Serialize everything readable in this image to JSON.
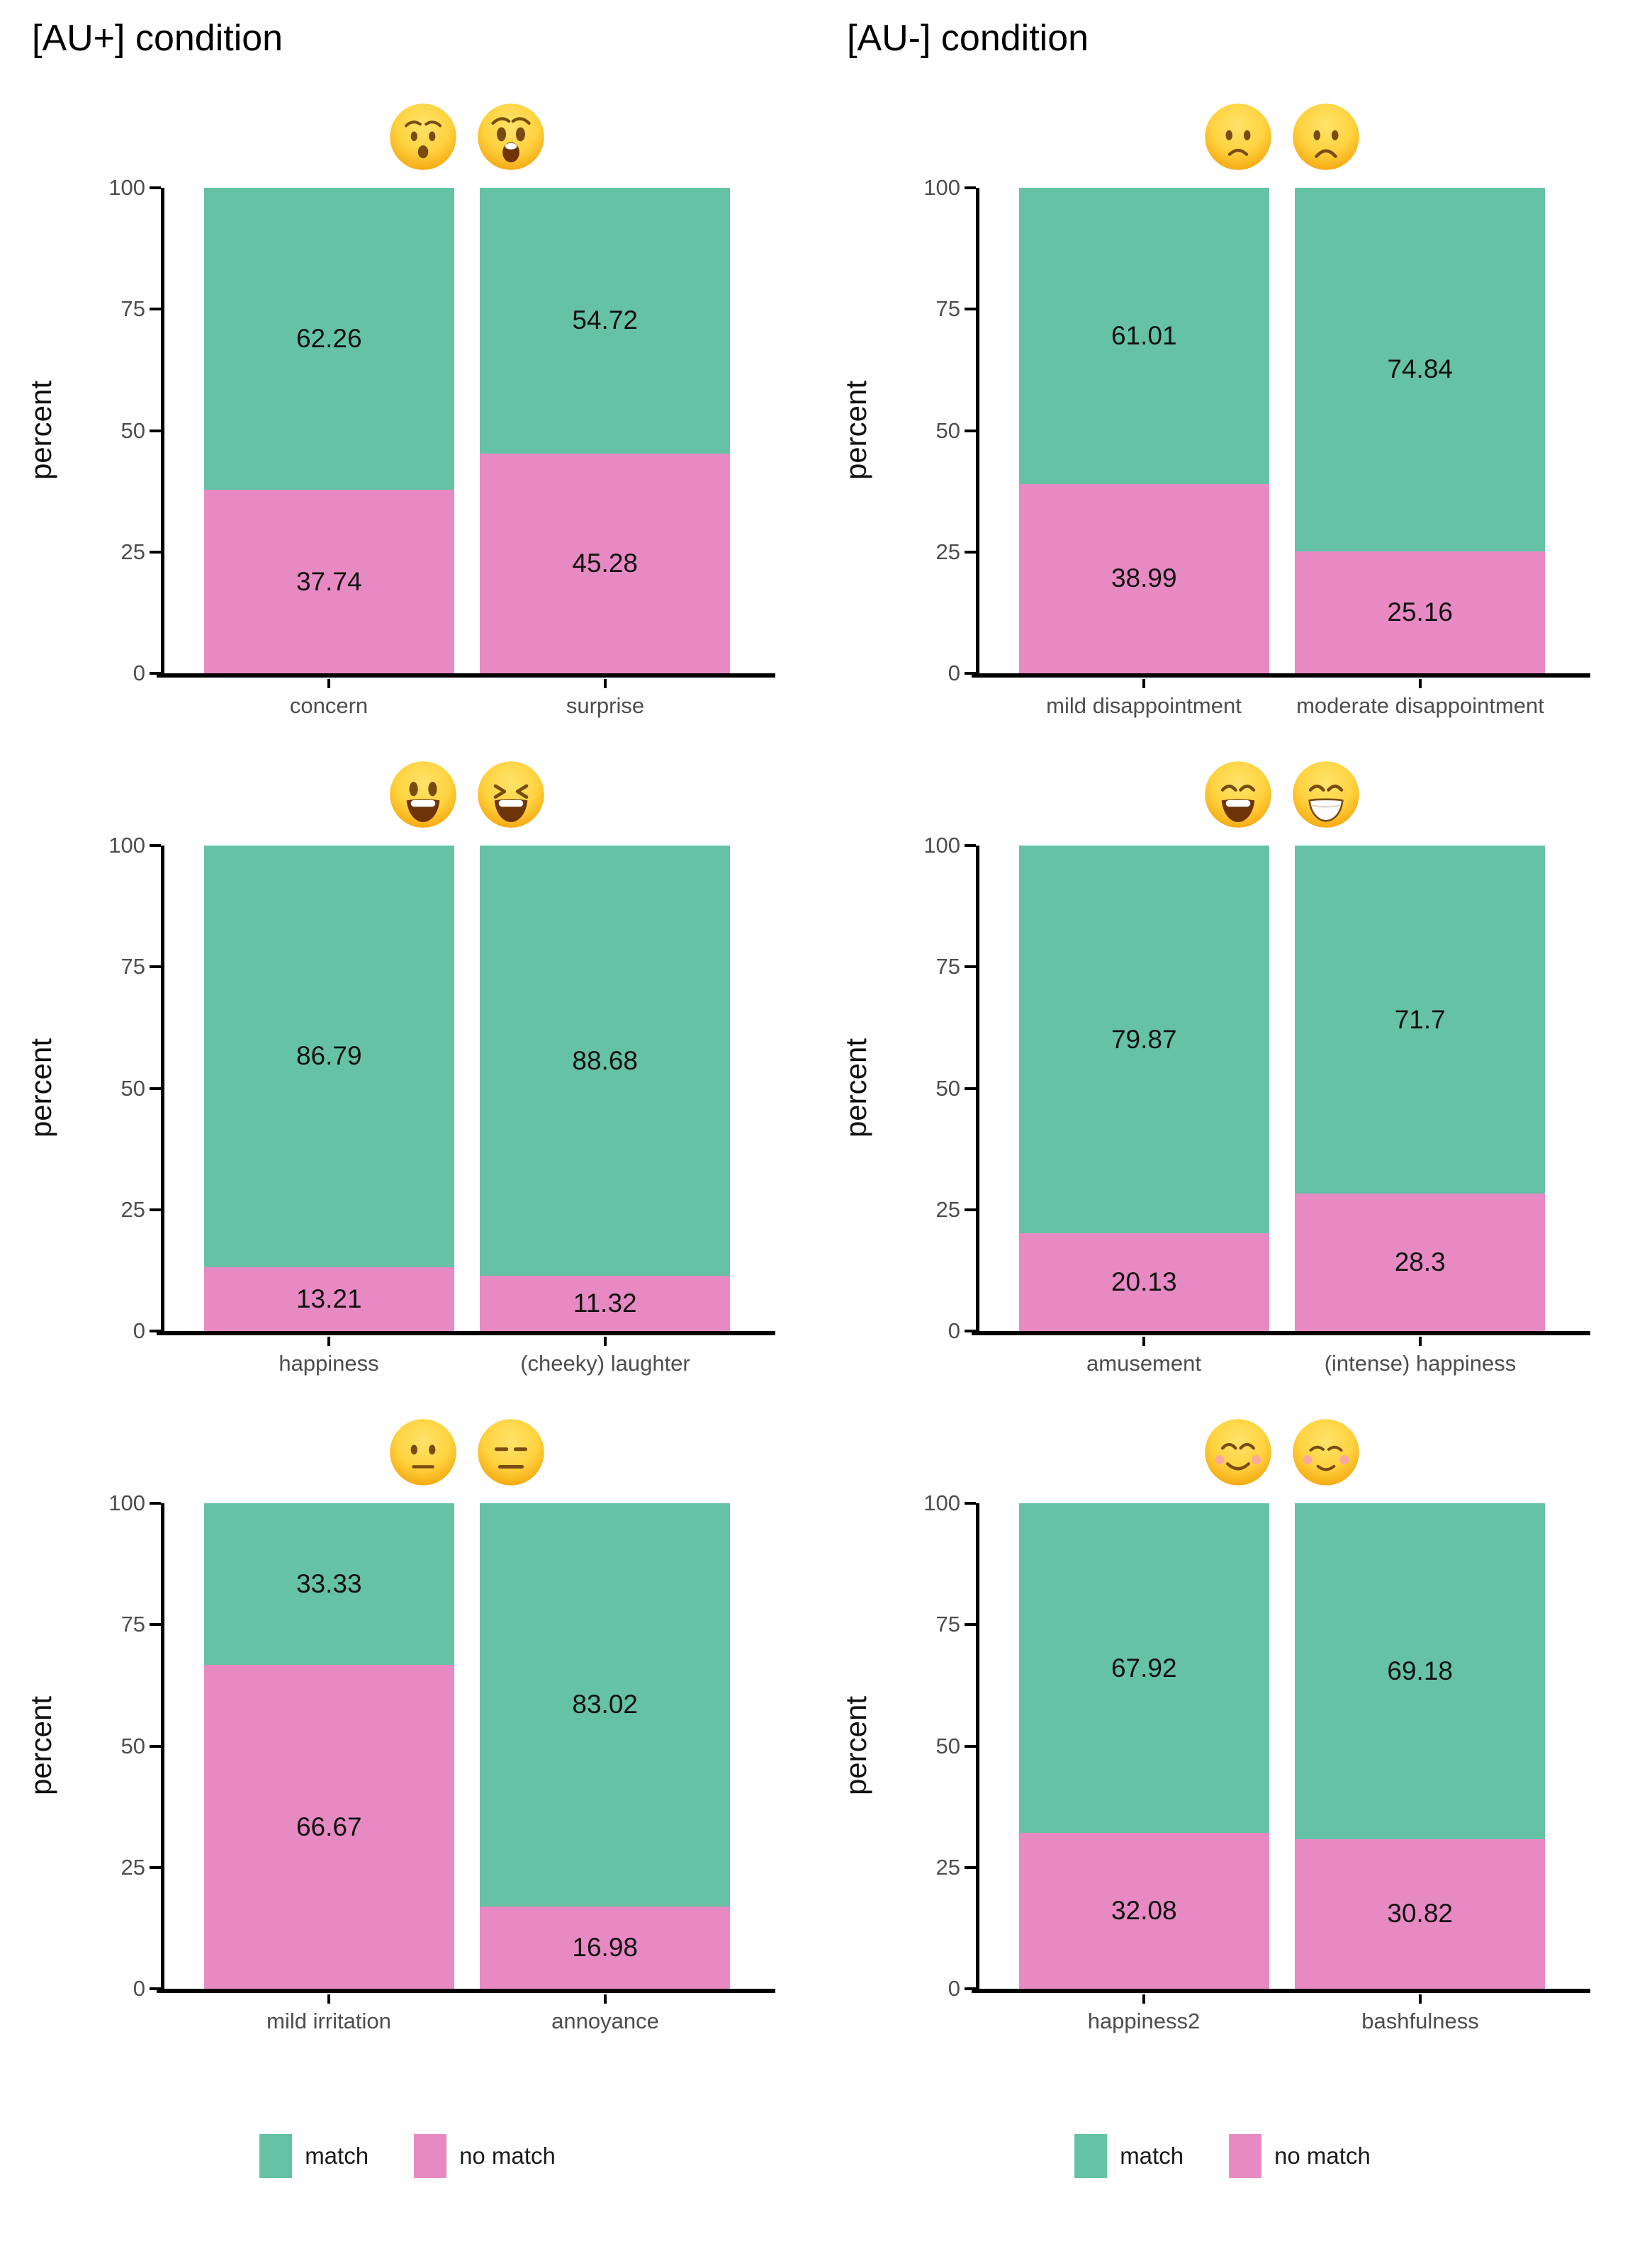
{
  "titles": {
    "left": "[AU+] condition",
    "right": "[AU-] condition"
  },
  "y_axis": {
    "label": "percent",
    "ticks": [
      100,
      75,
      50,
      25,
      0
    ]
  },
  "legend": {
    "match_label": "match",
    "no_match_label": "no match"
  },
  "colors": {
    "match": "#66C2A5",
    "no_match": "#E78AC3",
    "axis_text": "#4D4D4D",
    "axis_line": "#000000",
    "value_text": "#111111"
  },
  "chart_data": {
    "type": "bar",
    "subtype": "stacked-percent",
    "unit": "percent",
    "ylim": [
      0,
      100
    ],
    "grid": false,
    "legend_position": "bottom",
    "stack_order_top_to_bottom": [
      "match",
      "no match"
    ],
    "panels": [
      {
        "condition": "[AU+]",
        "emojis": [
          "hushed-face",
          "astonished-face"
        ],
        "categories": [
          "concern",
          "surprise"
        ],
        "match": [
          62.26,
          54.72
        ],
        "no_match": [
          37.74,
          45.28
        ]
      },
      {
        "condition": "[AU-]",
        "emojis": [
          "slightly-frowning-face",
          "frowning-face"
        ],
        "categories": [
          "mild disappointment",
          "moderate disappointment"
        ],
        "match": [
          61.01,
          74.84
        ],
        "no_match": [
          38.99,
          25.16
        ]
      },
      {
        "condition": "[AU+]",
        "emojis": [
          "grinning-face-big-eyes",
          "grinning-squinting-face"
        ],
        "categories": [
          "happiness",
          "(cheeky) laughter"
        ],
        "match": [
          86.79,
          88.68
        ],
        "no_match": [
          13.21,
          11.32
        ]
      },
      {
        "condition": "[AU-]",
        "emojis": [
          "grinning-face-smiling-eyes",
          "beaming-face-smiling-eyes"
        ],
        "categories": [
          "amusement",
          "(intense) happiness"
        ],
        "match": [
          79.87,
          71.7
        ],
        "no_match": [
          20.13,
          28.3
        ]
      },
      {
        "condition": "[AU+]",
        "emojis": [
          "neutral-face",
          "expressionless-face"
        ],
        "categories": [
          "mild irritation",
          "annoyance"
        ],
        "match": [
          33.33,
          83.02
        ],
        "no_match": [
          66.67,
          16.98
        ]
      },
      {
        "condition": "[AU-]",
        "emojis": [
          "smiling-face-smiling-eyes",
          "relaxed-smiling-face"
        ],
        "categories": [
          "happiness2",
          "bashfulness"
        ],
        "match": [
          67.92,
          69.18
        ],
        "no_match": [
          32.08,
          30.82
        ]
      }
    ]
  }
}
